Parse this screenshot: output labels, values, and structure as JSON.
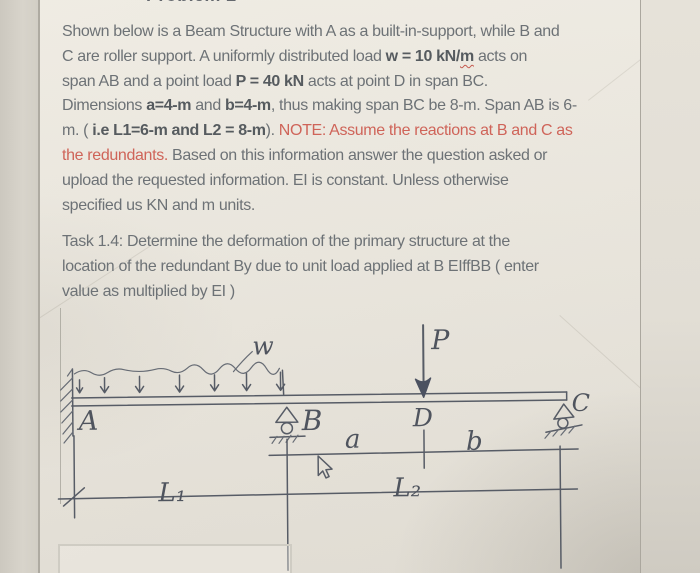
{
  "page": {
    "cropped_heading": "Problem 2"
  },
  "colors": {
    "paper": "#eae6dd",
    "text_gray": "#6d7276",
    "bold_gray": "#565b5f",
    "note_red": "#cf6459",
    "pencil": "#575c66"
  },
  "problem": {
    "lines": [
      [
        {
          "t": "Shown below is a Beam Structure  with A as a built-in-support, while B and"
        }
      ],
      [
        {
          "t": "C are roller support. A uniformly distributed load "
        },
        {
          "t": "w = 10 kN/",
          "b": true
        },
        {
          "t": "m",
          "b": true,
          "sq": true
        },
        {
          "t": " acts on"
        }
      ],
      [
        {
          "t": "span AB and a point load "
        },
        {
          "t": "P = 40 kN",
          "b": true
        },
        {
          "t": " acts at point D in span BC."
        }
      ],
      [
        {
          "t": "Dimensions "
        },
        {
          "t": "a=4-m",
          "b": true
        },
        {
          "t": " and "
        },
        {
          "t": "b=4-m",
          "b": true
        },
        {
          "t": ", thus making span BC be 8-m. Span AB is 6-"
        }
      ],
      [
        {
          "t": "m. ( "
        },
        {
          "t": "i.e L1=6-m and L2 = 8-m",
          "b": true
        },
        {
          "t": ").  "
        },
        {
          "t": "NOTE:  Assume the reactions at B and C as",
          "r": true
        }
      ],
      [
        {
          "t": "the redundants.",
          "r": true
        },
        {
          "t": "  Based on this information answer the question asked or"
        }
      ],
      [
        {
          "t": "upload the requested information.  EI is constant. Unless otherwise"
        }
      ],
      [
        {
          "t": "specified us KN and m units."
        }
      ]
    ]
  },
  "task": {
    "lines": [
      [
        {
          "t": "Task 1.4: Determine the deformation of the primary structure  at the"
        }
      ],
      [
        {
          "t": "location of the redundant By due to unit load applied at B EIffBB ( enter"
        }
      ],
      [
        {
          "t": "value as multiplied by EI )"
        }
      ]
    ]
  },
  "diagram": {
    "labels": {
      "A": "A",
      "B": "B",
      "C": "C",
      "D": "D",
      "a": "a",
      "b": "b",
      "w": "w",
      "P": "P",
      "L1": "L₁",
      "L2": "L₂"
    }
  }
}
